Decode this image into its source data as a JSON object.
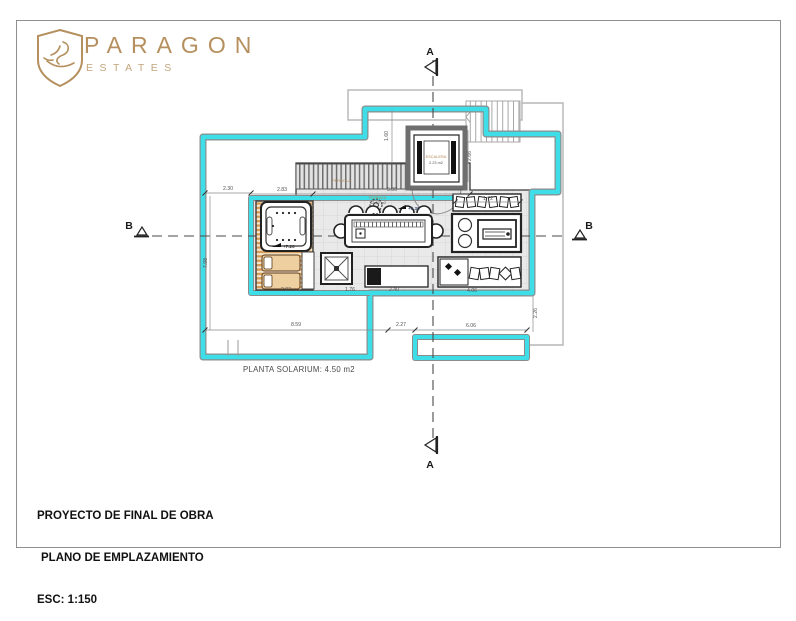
{
  "logo": {
    "brand": "PARAGON",
    "sub": "ESTATES"
  },
  "title_block": {
    "line1": "PROYECTO DE FINAL DE OBRA",
    "line2": "PLANO DE EMPLAZAMIENTO",
    "line3": "ESC: 1:150"
  },
  "plan": {
    "caption": "PLANTA SOLARIUM: 4.50 m2",
    "markers": {
      "a_top": "A",
      "a_bottom": "A",
      "b_left": "B",
      "b_right": "B"
    },
    "rooms": {
      "terrace_name": "TERRAZA",
      "terrace_area": "12.62 m2",
      "stair_name": "ESCALERA",
      "stair_area": "2.23 m2",
      "pergola_name": "PERGOLA"
    },
    "levels": {
      "deck": "+7.20",
      "terrace": "+6.30"
    },
    "dims": {
      "top_left": "2.30",
      "deck_top": "2.83",
      "pergola_top": "5.06",
      "bench_top": "1.72",
      "deck_bottom": "2.83",
      "drain_bottom": "1.76",
      "console_bottom": "2.40",
      "bench_bottom": "4.06",
      "bottom_left": "8.59",
      "bottom_mid": "2.27",
      "bottom_right": "6.06",
      "left_v": "7.98",
      "stair_v": "2.66",
      "notch_v": "1.60",
      "right_v": "2.26"
    },
    "colors": {
      "accent_cyan": "#3EDEE8",
      "logo_gold": "#B5905E",
      "wood": "#D59A56"
    }
  }
}
